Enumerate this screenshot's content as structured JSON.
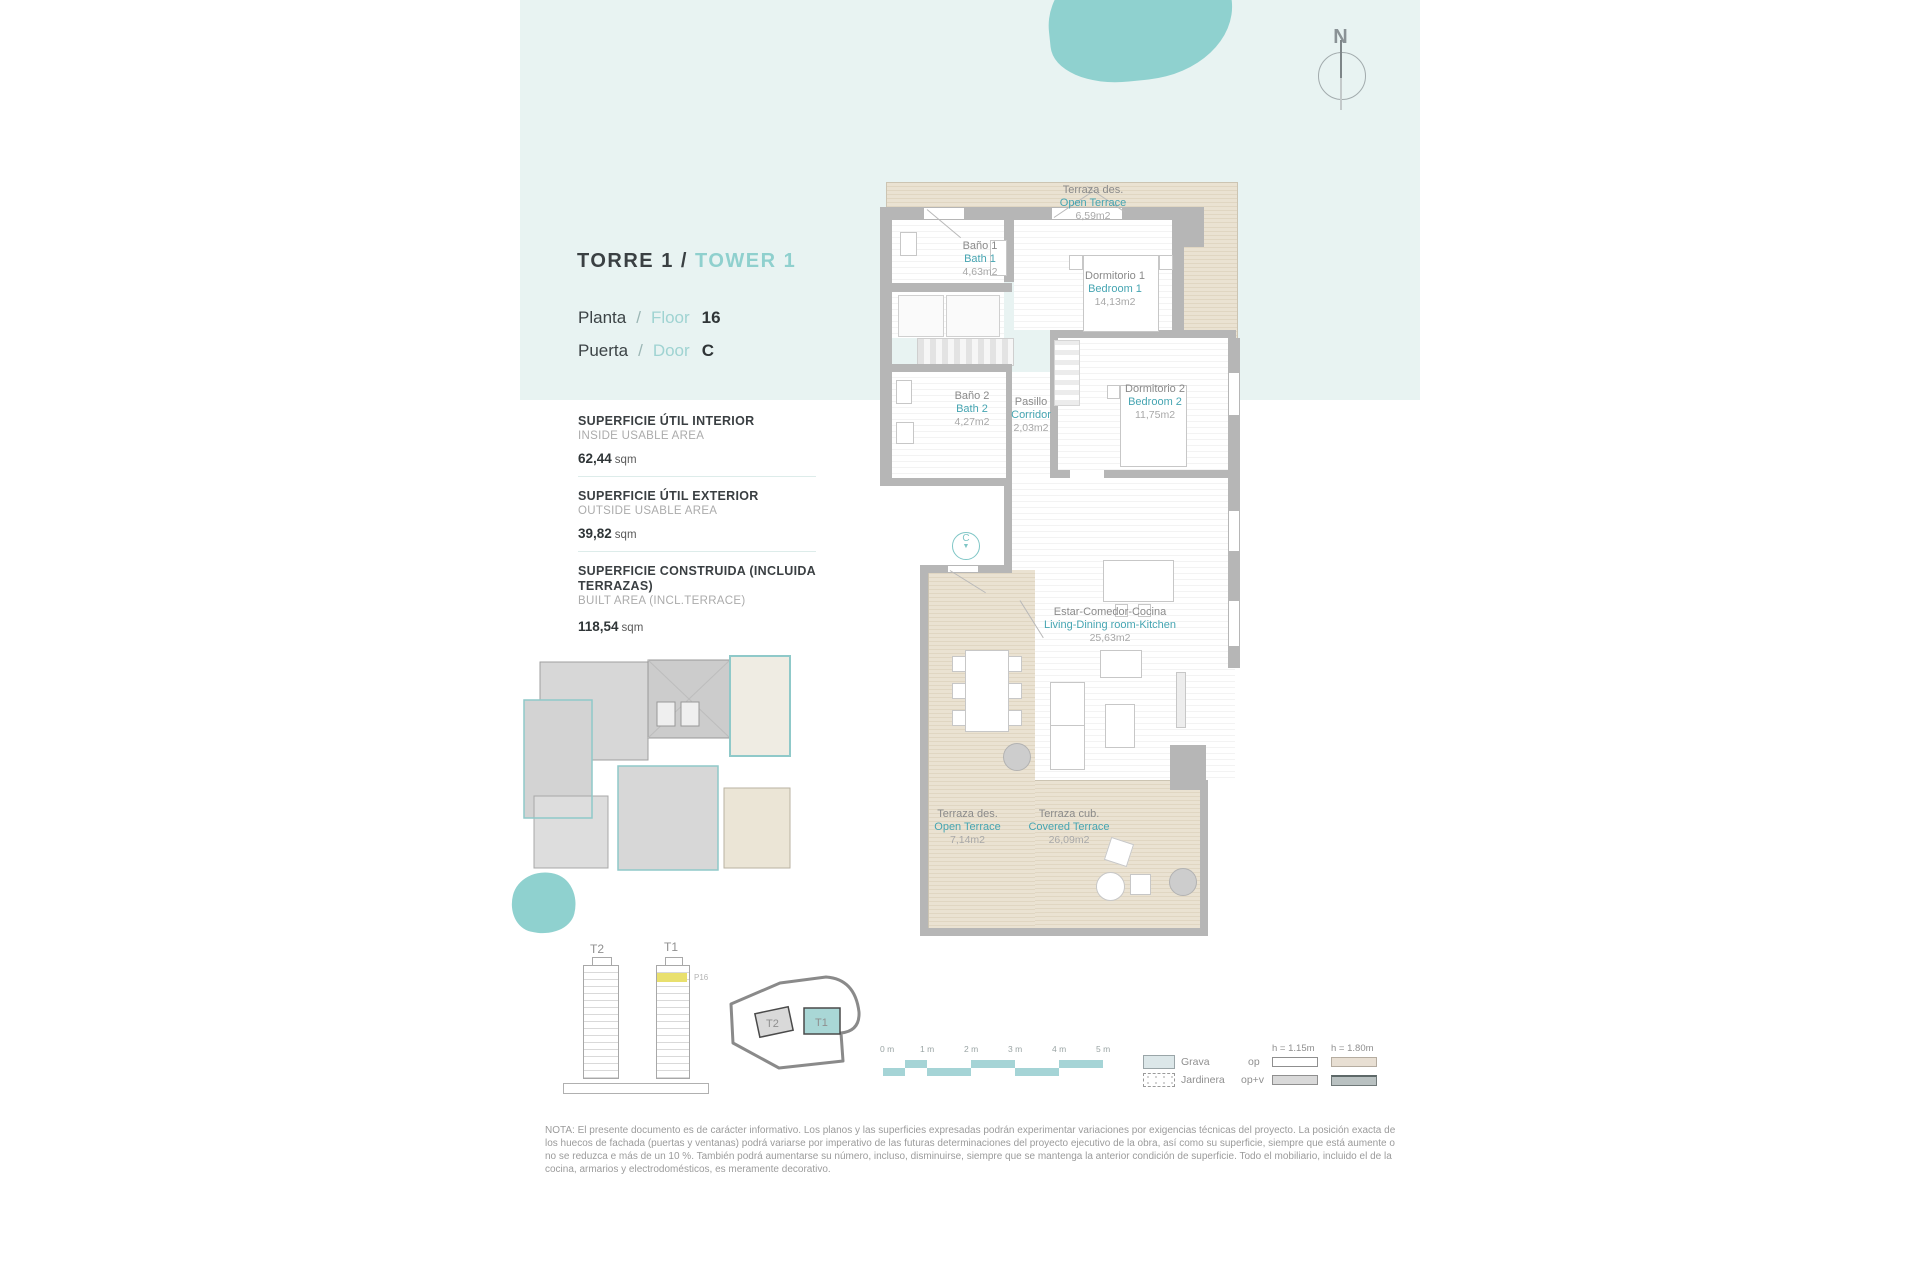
{
  "colors": {
    "accent_teal": "#8fd0ce",
    "accent_cyan": "#46a5b2",
    "band": "#e8f3f2",
    "terrace_beige": "#e9e1d1",
    "wall_grey": "#b6b6b6",
    "highlight_yellow": "#e9e06e",
    "scale_teal": "#a5d4d6"
  },
  "compass": {
    "label": "N"
  },
  "header": {
    "title_es": "TORRE 1 /",
    "title_en": "TOWER 1",
    "rows": [
      {
        "es": "Planta",
        "sep": "/",
        "en": "Floor",
        "value": "16"
      },
      {
        "es": "Puerta",
        "sep": "/",
        "en": "Door",
        "value": "C"
      }
    ]
  },
  "areas": [
    {
      "title_es": "SUPERFICIE ÚTIL INTERIOR",
      "title_en": "INSIDE USABLE AREA",
      "value": "62,44",
      "unit": "sqm"
    },
    {
      "title_es": "SUPERFICIE ÚTIL EXTERIOR",
      "title_en": "OUTSIDE USABLE AREA",
      "value": "39,82",
      "unit": "sqm"
    },
    {
      "title_es": "SUPERFICIE CONSTRUIDA (INCLUIDA TERRAZAS)",
      "title_en": "BUILT AREA (INCL.TERRACE)",
      "value": "118,54",
      "unit": "sqm"
    }
  ],
  "rooms": [
    {
      "es": "Terraza des.",
      "en": "Open Terrace",
      "area": "6,59m2"
    },
    {
      "es": "Baño 1",
      "en": "Bath 1",
      "area": "4,63m2"
    },
    {
      "es": "Dormitorio 1",
      "en": "Bedroom 1",
      "area": "14,13m2"
    },
    {
      "es": "Baño 2",
      "en": "Bath 2",
      "area": "4,27m2"
    },
    {
      "es": "Pasillo",
      "en": "Corridor",
      "area": "2,03m2"
    },
    {
      "es": "Dormitorio 2",
      "en": "Bedroom 2",
      "area": "11,75m2"
    },
    {
      "es": "Estar-Comedor-Cocina",
      "en": "Living-Dining room-Kitchen",
      "area": "25,63m2"
    },
    {
      "es": "Terraza des.",
      "en": "Open Terrace",
      "area": "7,14m2"
    },
    {
      "es": "Terraza cub.",
      "en": "Covered Terrace",
      "area": "26,09m2"
    }
  ],
  "door_marker": {
    "label": "C",
    "arrow_icon": "▼"
  },
  "towers": {
    "t2_label": "T2",
    "t1_label": "T1",
    "highlight_label": "P16"
  },
  "site_plan": {
    "t2_label": "T2",
    "t1_label": "T1"
  },
  "scale_bar": {
    "ticks": [
      "0 m",
      "1 m",
      "2 m",
      "3 m",
      "4 m",
      "5 m"
    ]
  },
  "legend": {
    "grava": "Grava",
    "jardinera": "Jardinera",
    "op": "op",
    "op_v": "op+v",
    "h115": "h = 1.15m",
    "h180": "h = 1.80m"
  },
  "note": "NOTA: El presente documento es de carácter informativo. Los planos y las superficies expresadas podrán experimentar variaciones por exigencias técnicas del proyecto. La posición exacta de los huecos de fachada (puertas y ventanas) podrá variarse por imperativo de las futuras determinaciones del proyecto ejecutivo de la obra, así como su superficie, siempre que está aumente o no se reduzca e más de un 10 %. También podrá aumentarse su número, incluso, disminuirse, siempre que se mantenga la anterior condición de superficie. Todo el mobiliario, incluido el de la cocina, armarios y electrodomésticos, es meramente decorativo."
}
